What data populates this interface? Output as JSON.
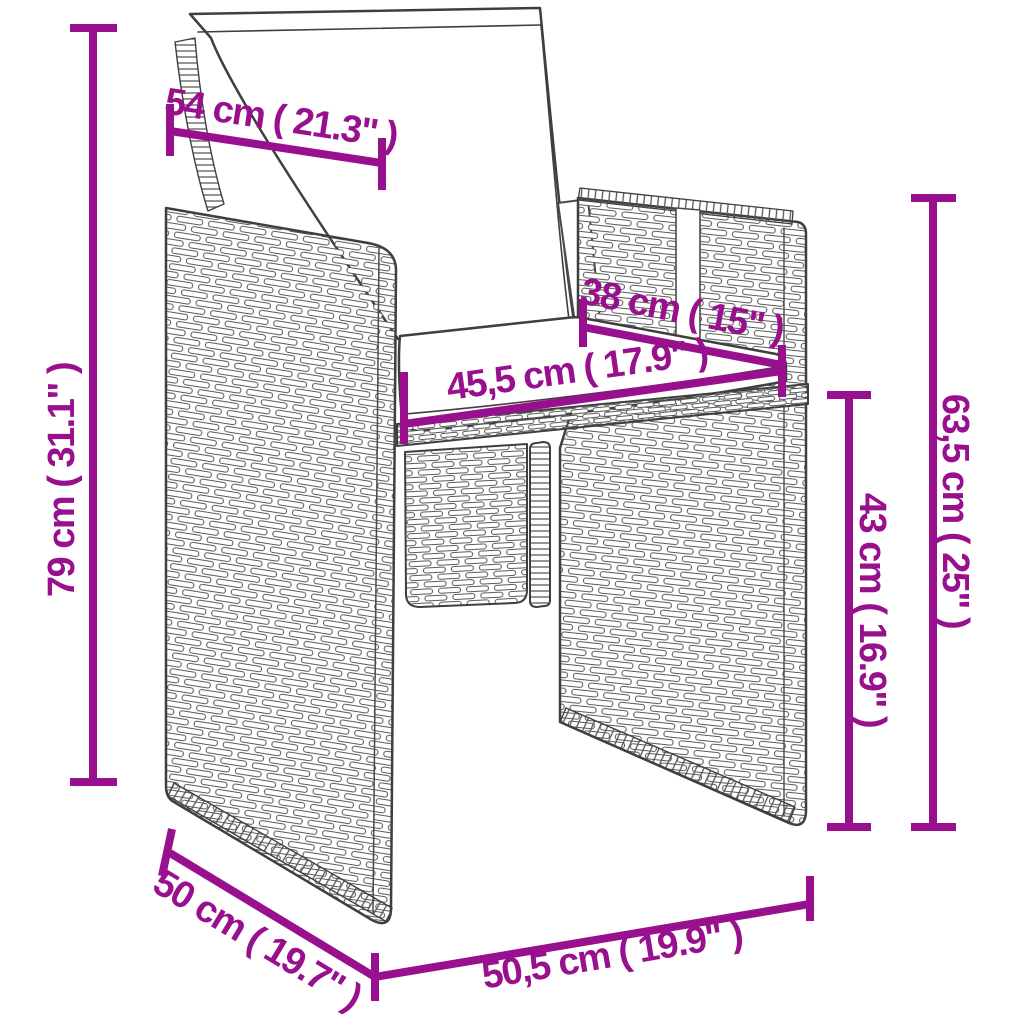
{
  "page": {
    "background_color": "#ffffff",
    "accent_color": "#98108E",
    "line_art_color": "#3f3f3f",
    "subject": "poly rattan dining chair with back and seat cushions, dimension diagram"
  },
  "diagram": {
    "dimensions": [
      {
        "id": "backrest-width-top",
        "label": "54 cm ( 21.3\" )"
      },
      {
        "id": "overall-height",
        "label": "79 cm ( 31.1\" )"
      },
      {
        "id": "backrest-top-depth",
        "label": "38 cm ( 15\" )"
      },
      {
        "id": "seat-inner-width",
        "label": "45,5 cm ( 17.9\" )"
      },
      {
        "id": "armrest-height",
        "label": "63,5 cm ( 25\" )"
      },
      {
        "id": "seat-height",
        "label": "43 cm ( 16.9\" )"
      },
      {
        "id": "side-depth",
        "label": "50 cm ( 19.7\" )"
      },
      {
        "id": "front-width",
        "label": "50,5 cm ( 19.9\" )"
      }
    ]
  }
}
